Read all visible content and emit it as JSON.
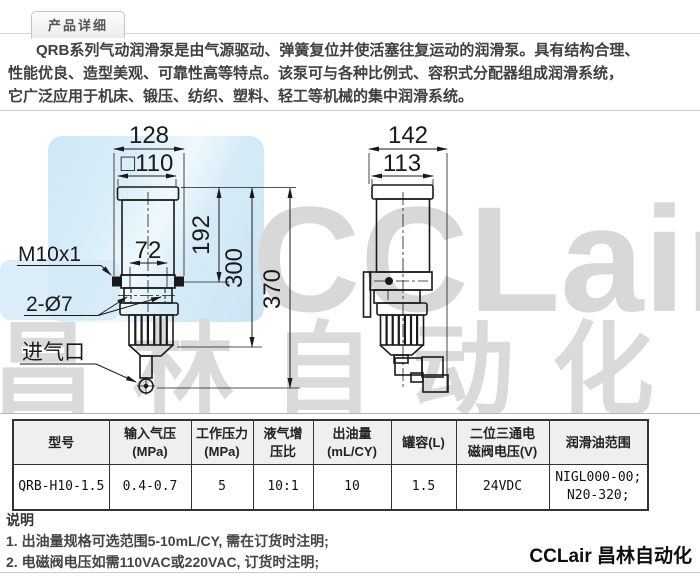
{
  "header": {
    "tab": "产品详细"
  },
  "description": {
    "line1": "QRB系列气动润滑泵是由气源驱动、弹簧复位并使活塞往复运动的润滑泵。具有结构合理、",
    "line2": "性能优良、造型美观、可靠性高等特点。该泵可与各种比例式、容积式分配器组成润滑系统，",
    "line3": "它广泛应用于机床、锻压、纺织、塑料、轻工等机械的集中润滑系统。"
  },
  "drawing": {
    "front": {
      "dim_128": "128",
      "dim_110": "□110",
      "dim_72": "72",
      "dim_192": "192",
      "dim_300": "300",
      "dim_370": "370",
      "label_thread": "M10x1",
      "label_holes": "2-Ø7",
      "label_inlet": "进气口"
    },
    "side": {
      "dim_142": "142",
      "dim_113": "113"
    },
    "watermark": {
      "brand": "CCLair",
      "brand_cn": "昌林自动化"
    }
  },
  "colors": {
    "watermark_blue": "#cfe8f6",
    "watermark_gray": "#d8d8d8",
    "drawing_line": "#1a1a1a",
    "table_border": "#333333",
    "header_bg": "#efefef"
  },
  "table": {
    "headers": [
      {
        "l1": "型号",
        "l2": ""
      },
      {
        "l1": "输入气压",
        "l2": "(MPa)"
      },
      {
        "l1": "工作压力",
        "l2": "(MPa)"
      },
      {
        "l1": "液气增",
        "l2": "压比"
      },
      {
        "l1": "出油量",
        "l2": "(mL/CY)"
      },
      {
        "l1": "罐容(L)",
        "l2": ""
      },
      {
        "l1": "二位三通电",
        "l2": "磁阀电压(V)"
      },
      {
        "l1": "润滑油范围",
        "l2": ""
      }
    ],
    "row": {
      "model": "QRB-H10-1.5",
      "input_pressure_mpa": "0.4-0.7",
      "working_pressure_mpa": "5",
      "ratio": "10:1",
      "output_ml_cy": "10",
      "tank_l": "1.5",
      "valve_voltage": "24VDC",
      "oil_range_l1": "NIGL000-00;",
      "oil_range_l2": "N20-320;"
    }
  },
  "notes": {
    "title": "说明",
    "item1": "1. 出油量规格可选范围5-10mL/CY, 需在订货时注明;",
    "item2": "2. 电磁阀电压如需110VAC或220VAC, 订货时注明;"
  },
  "footer": {
    "brand": "CCLair 昌林自动化"
  }
}
